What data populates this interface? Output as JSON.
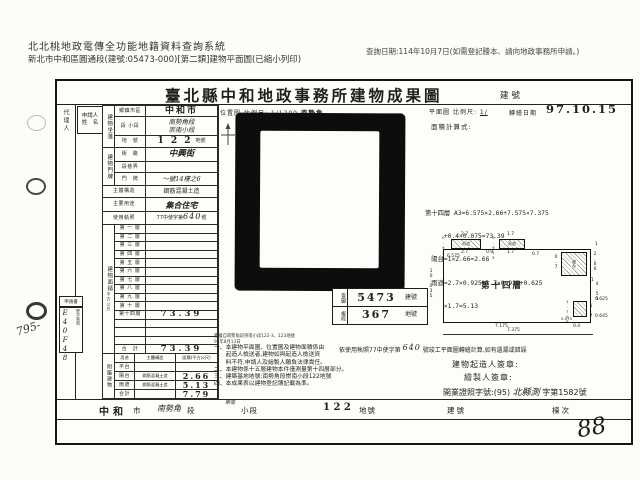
{
  "colors": {
    "paper": "#fcfcf9",
    "ink": "#1f1f1f",
    "map_black": "#0d0d0d"
  },
  "h": {
    "sys": "北北桃地政電傳全功能地籍資料查詢系統",
    "print": "新北市中和區圓通段(建號:05473-000)[第二類]建物平面圖(已縮小列印)",
    "date": "查詢日期:114年10月7日(如需登記謄本、請向地政事務所申請。)"
  },
  "d": {
    "title": "臺北縣中和地政事務所建物成果圖",
    "bno": "建號",
    "margin": "代理人",
    "applicant": "申請人\n姓　名",
    "loc": {
      "sec": "建物坐落",
      "rows": [
        {
          "l": "鄉鎮市區",
          "v": "中和市"
        },
        {
          "l": "段 小段",
          "v": "南勢角段\n崇南小段"
        },
        {
          "l": "地　號",
          "v": "1 2 2"
        },
        {
          "l": "地號單位",
          "v": "地號"
        }
      ]
    },
    "addr": {
      "sec": "建物門牌",
      "rows": [
        {
          "l": "街　路",
          "v": "中興街"
        },
        {
          "l": "段巷弄",
          "v": ""
        },
        {
          "l": "門　牌",
          "v": "～號14樓之6"
        }
      ]
    },
    "structure": {
      "l": "主體構造",
      "v": "鋼筋混凝土造"
    },
    "usage": {
      "l": "主要用途",
      "v": "集合住宅"
    },
    "license": {
      "l": "使用執照",
      "pre": "77中使字第",
      "num": "640",
      "suf": "號"
    },
    "area": {
      "sec": "建物面積",
      "unit": "平方公尺"
    },
    "floors": [
      {
        "l": "第 一 層",
        "v": ""
      },
      {
        "l": "第 二 層",
        "v": ""
      },
      {
        "l": "第 三 層",
        "v": ""
      },
      {
        "l": "第 四 層",
        "v": ""
      },
      {
        "l": "第 五 層",
        "v": ""
      },
      {
        "l": "第 六 層",
        "v": ""
      },
      {
        "l": "第 七 層",
        "v": ""
      },
      {
        "l": "第 八 層",
        "v": ""
      },
      {
        "l": "第 九 層",
        "v": ""
      },
      {
        "l": "第 十 層",
        "v": ""
      },
      {
        "l": "第十四層",
        "v": "73.39"
      },
      {
        "l": "",
        "v": ""
      },
      {
        "l": "",
        "v": ""
      },
      {
        "l": "",
        "v": ""
      },
      {
        "l": "合　計",
        "v": "73.39"
      }
    ],
    "annex": {
      "sec": "附屬建物",
      "h": {
        "use": "用途",
        "structure": "主體構造",
        "area": "面積(平方公尺)"
      },
      "rows": [
        {
          "u": "平台",
          "s": "",
          "a": ""
        },
        {
          "u": "陽台",
          "s": "鋼筋混凝土造",
          "a": "2.66"
        },
        {
          "u": "雨遮",
          "s": "鋼筋混凝土造",
          "a": "5.13"
        },
        {
          "u": "合計",
          "s": "",
          "a": "7.79"
        }
      ]
    },
    "app": {
      "box": "申請書",
      "case_label": "謄字第號",
      "hand": "E40F48",
      "scribble": "795-"
    },
    "map": {
      "label": "位置圖",
      "scale_label": "比例尺:",
      "scale": "1/1200",
      "name": "南勢角"
    },
    "stamp": [
      {
        "l": "查圖",
        "n": "5473",
        "u": "建號"
      },
      {
        "l": "複段",
        "n": "367",
        "u": "地號"
      }
    ],
    "plan": {
      "label": "平面圖",
      "scale_label": "比例尺:",
      "scale": "1/",
      "date_label": "轉繪日期",
      "date": "97.10.15",
      "calc_label": "面積計算式:",
      "calc": [
        "第十四層 A3=6.575×2.66+7.575×7.375",
        "　　　+0.4×0.075=73.39",
        "　陽台=1×2.66=2.66",
        "　雨遮=2.7×0.925+1.7×0.925+0.625",
        "　　　×1.7=5.13"
      ],
      "room": "第十四層",
      "dims": {
        "t1": "2.7",
        "t2": "0.9",
        "t3": "1.7",
        "t4": "0.7",
        "one": "1",
        "canopy": "雨遮",
        "balcony": "陽台",
        "ch": "0.925",
        "l1": "6.575",
        "l2": "10.035",
        "v07": "0.7",
        "r1": "2.66",
        "r2": "4.55",
        "r3": "0.625",
        "r4": "1.7",
        "r5": "0.645",
        "r6": "1.708",
        "r7": "0.075",
        "b1": "7.175",
        "b2": "0.4",
        "b3": "7.375"
      }
    },
    "notes": {
      "s1": "謄繪自南勢角段崇南小段122-3、123地號",
      "s2": "97年8月13日",
      "items": [
        "一、本建物平面圖、位置圖及建物面積係由",
        "　　起造人檢送者,建物如與起造人檢送資",
        "　　料不符,申請人及繪製人願負法律責任。",
        "二、本建物係十五層建物本件僅測量第十四層部分。",
        "三、建築基地地號:南勢角段崇南小段122地號",
        "四、本成果表以建物登記簿記載為準。"
      ]
    },
    "cert": {
      "pre": "依使用執照77中使字第",
      "num": "640",
      "suf": "號竣工平面圖轉繪計算,如有遺漏或錯誤",
      "builder": "建物起造人簽章:",
      "drafter": "繪製人簽章:",
      "lic_pre": "開業證照字號:(95)",
      "lic_hand": "北縣測",
      "lic_suf": "字第1582號"
    },
    "strip": {
      "city": "中和",
      "city_u": "市",
      "sec": "南勢角",
      "sec_u": "段",
      "sub": "崇南",
      "sub_u": "小段",
      "lot": "1 2 2",
      "lot_u": "地號",
      "bno": "建號",
      "dong": "棟次"
    },
    "page_no": "88"
  }
}
